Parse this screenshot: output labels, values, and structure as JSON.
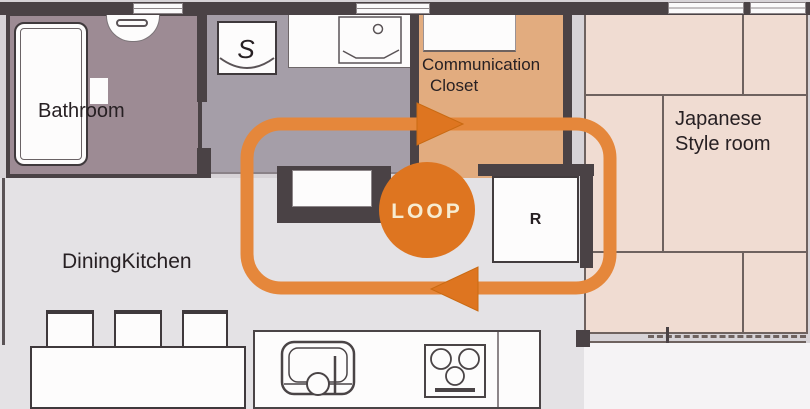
{
  "rooms": {
    "bathroom": {
      "label": "Bathroom"
    },
    "communication_closet": {
      "line1": "Communication",
      "line2": "Closet"
    },
    "japanese_room": {
      "line1": "Japanese",
      "line2": "Style room"
    },
    "dining_kitchen": {
      "label": "DiningKitchen"
    }
  },
  "markers": {
    "toilet": "S",
    "refrigerator": "R"
  },
  "loop": {
    "label": "LOOP"
  },
  "colors": {
    "wall": "#4a4245",
    "line": "#6e625f",
    "bathroom": "#9d8b94",
    "washroom": "#a59ea8",
    "closet": "#e2ac7f",
    "japanese": "#f0dcd2",
    "floor": "#e4e2e5",
    "canvas": "#d7d3d7",
    "white-area": "#f5f3f5",
    "fixture": "#fdfcfc",
    "loop-stroke": "#e5873b",
    "loop-solid": "#de7520",
    "loop-text": "#f7ecd1",
    "text": "#272023"
  }
}
